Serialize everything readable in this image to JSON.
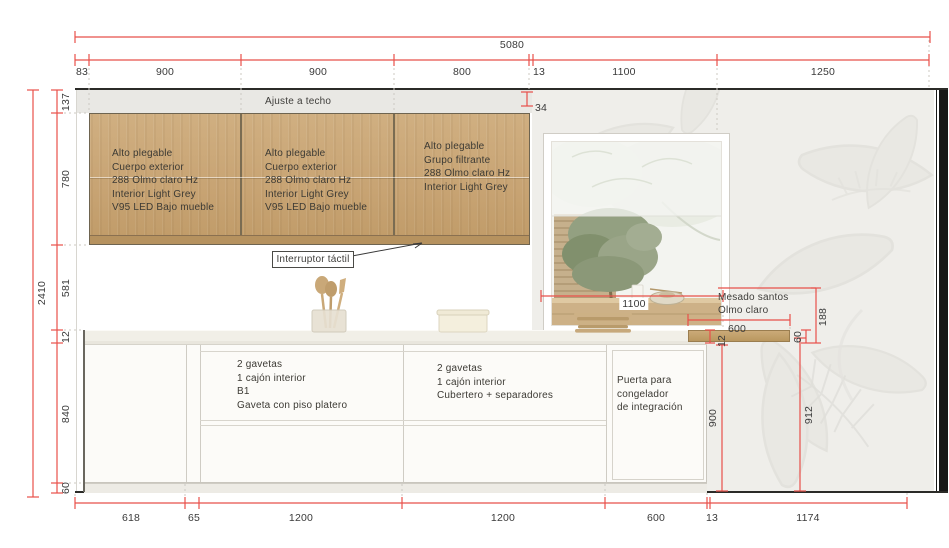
{
  "drawing": {
    "ceiling_note": "Ajuste a techo",
    "switch_note": "Interruptor táctil",
    "counter_note_1": "Mesado santos",
    "counter_note_2": "Olmo claro"
  },
  "upper_cabinets": [
    {
      "lines": [
        "Alto plegable",
        "Cuerpo exterior",
        "288 Olmo claro Hz",
        "Interior  Light Grey",
        "V95 LED Bajo mueble"
      ]
    },
    {
      "lines": [
        "Alto plegable",
        "Cuerpo exterior",
        "288 Olmo claro Hz",
        "Interior  Light Grey",
        "V95 LED Bajo mueble"
      ]
    },
    {
      "lines": [
        "Alto plegable",
        "Grupo filtrante",
        "288 Olmo claro Hz",
        "Interior  Light Grey"
      ]
    }
  ],
  "base_cabinets": [
    {
      "lines": [
        "2 gavetas",
        "1 cajón interior",
        "B1",
        "Gaveta con piso platero"
      ]
    },
    {
      "lines": [
        "2 gavetas",
        "1 cajón interior",
        "Cubertero + separadores"
      ]
    },
    {
      "lines": [
        "Puerta para",
        "congelador",
        "de integración"
      ]
    }
  ],
  "dims": {
    "total_width": "5080",
    "top": [
      "83",
      "900",
      "900",
      "800",
      "13",
      "1100",
      "1250"
    ],
    "top_offset": "34",
    "height_total": "2410",
    "left": [
      "137",
      "780",
      "581",
      "12",
      "840",
      "60"
    ],
    "bottom": [
      "618",
      "65",
      "1200",
      "1200",
      "600",
      "13",
      "1174"
    ],
    "window_width": "1100",
    "shelf_width": "600",
    "counter_thickness": "12",
    "base_height": "900",
    "shelf_thickness": "60",
    "shelf_drop": "188",
    "right_height": "912"
  },
  "colors": {
    "dimension": "#e8504a",
    "wood": "#c9a678",
    "wallpaper": "#efeeea"
  }
}
